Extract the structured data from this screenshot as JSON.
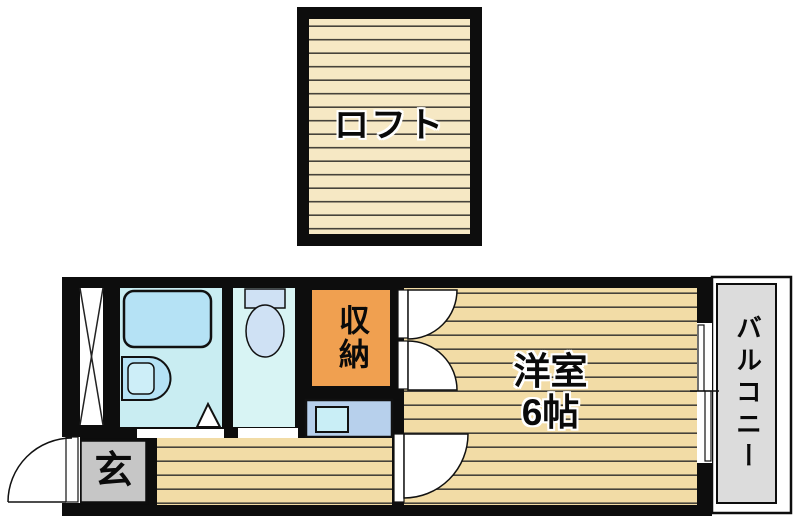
{
  "plan": {
    "loft": {
      "label": "ロフト"
    },
    "entrance": {
      "label": "玄"
    },
    "storage": {
      "label": "収納"
    },
    "western_room": {
      "name": "洋室",
      "size": "6帖"
    },
    "balcony": {
      "label": "バルコニー"
    }
  },
  "fixtures": [
    "loft-ladder",
    "bathtub",
    "washbasin",
    "folding-door",
    "toilet",
    "storage-double-door",
    "kitchen-sink",
    "room-hinged-door",
    "toilet-hinged-door",
    "entrance-door",
    "sliding-window"
  ],
  "colors": {
    "wall": "#0d0d0d",
    "wood_floor": "#f2dca6",
    "floor_stripe": "#46423a",
    "loft_floor": "#f6e8c4",
    "bathroom": "#c9edf2",
    "toilet_room": "#d8f4f4",
    "fixture_blue": "#b5e2f5",
    "fixture_inner_blue": "#cdeef8",
    "toilet_fixture": "#cfe1f4",
    "storage_orange": "#f0a050",
    "kitchen_counter": "#b7d0ec",
    "kitchen_sink": "#c9eef6",
    "entrance_gray": "#c6c6c6",
    "balcony_gray": "#dcdcdc"
  }
}
